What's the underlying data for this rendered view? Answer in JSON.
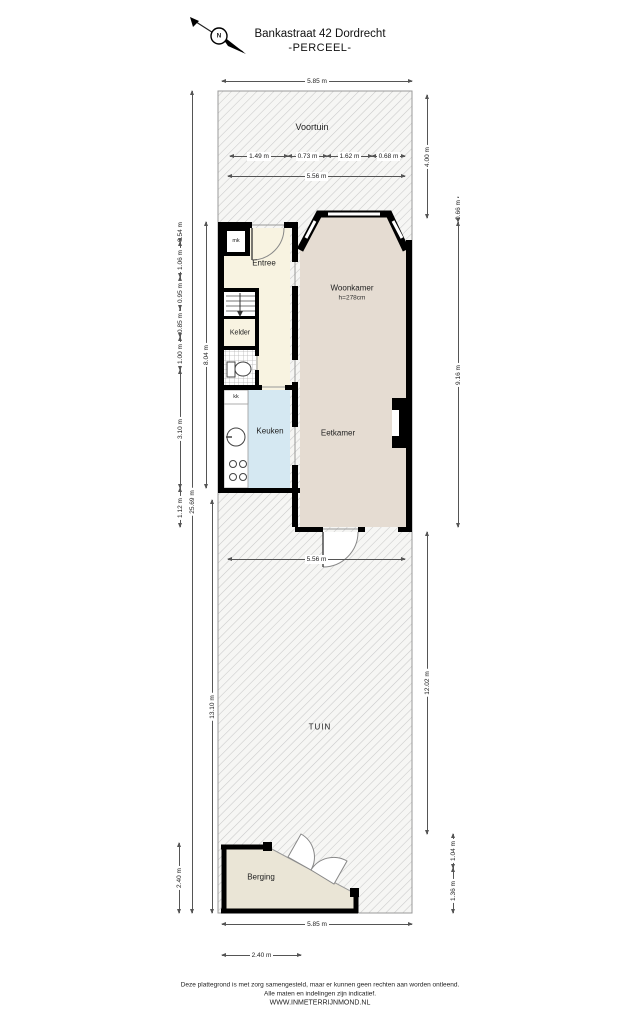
{
  "title": {
    "address": "Bankastraat 42 Dordrecht",
    "subtitle": "-PERCEEL-"
  },
  "compass": {
    "north": "N"
  },
  "rooms": {
    "voortuin": {
      "label": "Voortuin"
    },
    "entree": {
      "label": "Entree"
    },
    "meterkast": {
      "label": "mk"
    },
    "kelder": {
      "label": "Kelder"
    },
    "keukenkast": {
      "label": "kk"
    },
    "keuken": {
      "label": "Keuken"
    },
    "woonkamer": {
      "label": "Woonkamer",
      "ceiling_height": "h=278cm"
    },
    "eetkamer": {
      "label": "Eetkamer"
    },
    "tuin": {
      "label": "TUIN"
    },
    "berging": {
      "label": "Berging"
    }
  },
  "dimensions": {
    "plot_width_top": "5.85 m",
    "voortuin_depth": "4.00 m",
    "facade_seg_1": "1.49 m",
    "facade_seg_2": "0.73 m",
    "facade_seg_3": "1.62 m",
    "facade_seg_4": "0.68 m",
    "inner_width_top": "5.56 m",
    "bay_depth": "0.66 m",
    "house_depth_right": "9.16 m",
    "tuin_depth_right": "12.02 m",
    "berging_right_upper": "1.04 m",
    "berging_right_lower": "1.36 m",
    "plot_depth_total": "25.69 m",
    "tuin_depth_left": "13.10 m",
    "left_seg_1": "0.54 m",
    "left_seg_2": "1.06 m",
    "left_seg_3": "0.95 m",
    "left_seg_4": "0.85 m",
    "left_seg_5": "1.00 m",
    "left_seg_6": "3.10 m",
    "left_seg_7": "1.12 m",
    "house_depth_left": "8.04 m",
    "berging_depth_left": "2.40 m",
    "inner_width_bottom": "5.56 m",
    "plot_width_bottom": "5.85 m",
    "berging_width": "2.40 m"
  },
  "footer": {
    "line1": "Deze plattegrond is met zorg samengesteld, maar er kunnen geen rechten aan worden ontleend.",
    "line2": "Alle maten en indelingen zijn indicatief.",
    "line3": "WWW.INMETERRIJNMOND.NL"
  },
  "colors": {
    "wall": "#000000",
    "floor_cream": "#f8f3e1",
    "floor_living": "#e5dcd2",
    "floor_kitchen": "#d5e8f2",
    "floor_berging": "#eae5d6",
    "hatch_line": "#c9c9c9",
    "dim_line": "#555555"
  }
}
